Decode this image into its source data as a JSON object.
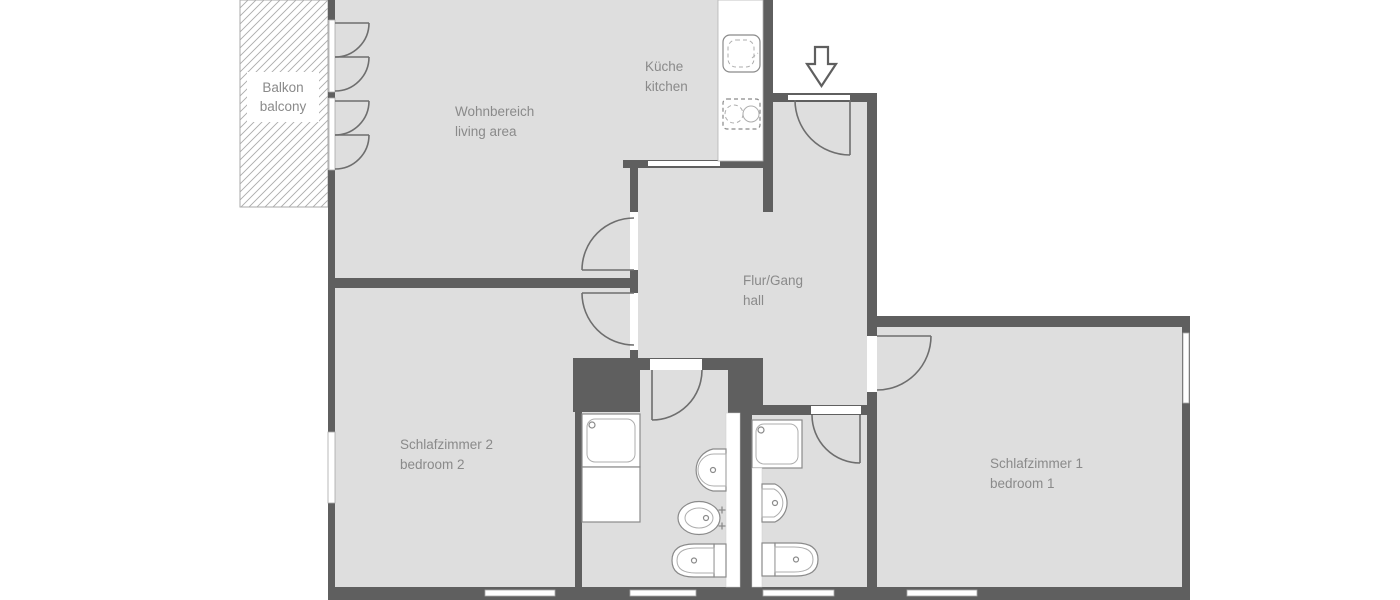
{
  "plan": {
    "type": "apartment floor plan",
    "rooms": {
      "balcony": {
        "de": "Balkon",
        "en": "balcony"
      },
      "living": {
        "de": "Wohnbereich",
        "en": "living area"
      },
      "kitchen": {
        "de": "Küche",
        "en": "kitchen"
      },
      "hall": {
        "de": "Flur/Gang",
        "en": "hall"
      },
      "bedroom2": {
        "de": "Schlafzimmer 2",
        "en": "bedroom 2"
      },
      "bedroom1": {
        "de": "Schlafzimmer 1",
        "en": "bedroom 1"
      }
    },
    "colors": {
      "background": "#ffffff",
      "floor": "#dedede",
      "wall": "#5f5f5f",
      "door_line": "#6e6e6e",
      "fixture_line": "#8a8a8a",
      "text": "#8a8a8a"
    }
  }
}
